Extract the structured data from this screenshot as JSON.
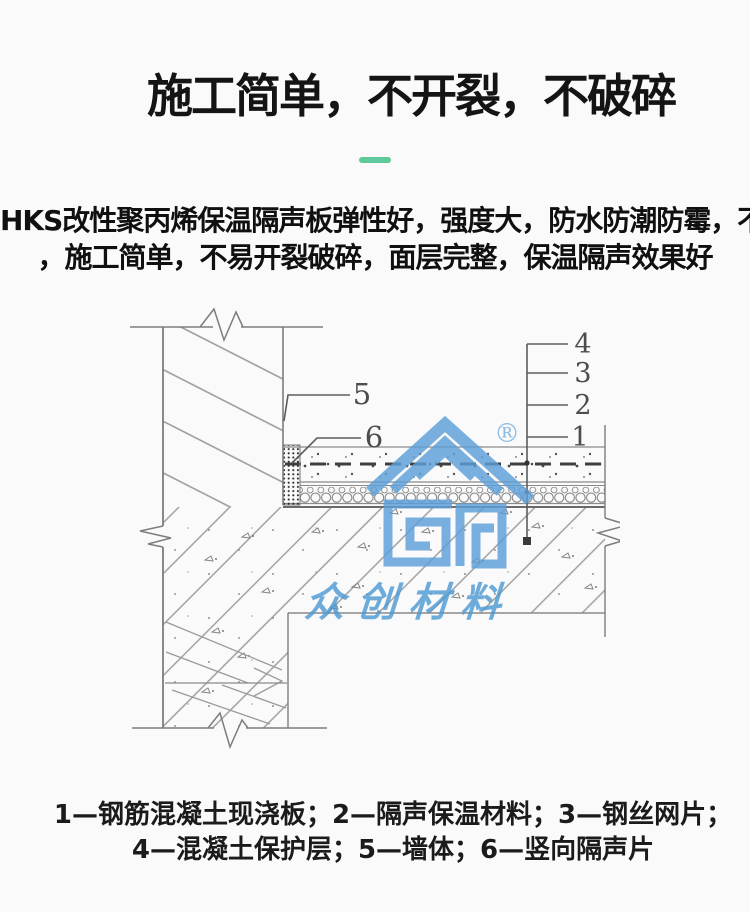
{
  "header": {
    "title": "施工简单，不开裂，不破碎",
    "accent_color": "#5fc99b"
  },
  "intro": {
    "line1": "HKS改性聚丙烯保温隔声板弹性好，强度大，防水防潮防霉，不惧重压",
    "line2": "，施工简单，不易开裂破碎，面层完整，保温隔声效果好"
  },
  "diagram": {
    "callouts": {
      "c1": "1",
      "c2": "2",
      "c3": "3",
      "c4": "4",
      "c5": "5",
      "c6": "6"
    },
    "watermark": {
      "registered": "®",
      "brand": "众创材料",
      "color": "#5C9FD9"
    },
    "line_color": "#8a8a8a"
  },
  "legend": {
    "line1": "1—钢筋混凝土现浇板；2—隔声保温材料；3—钢丝网片；",
    "line2": "4—混凝土保护层；5—墙体；6—竖向隔声片"
  }
}
